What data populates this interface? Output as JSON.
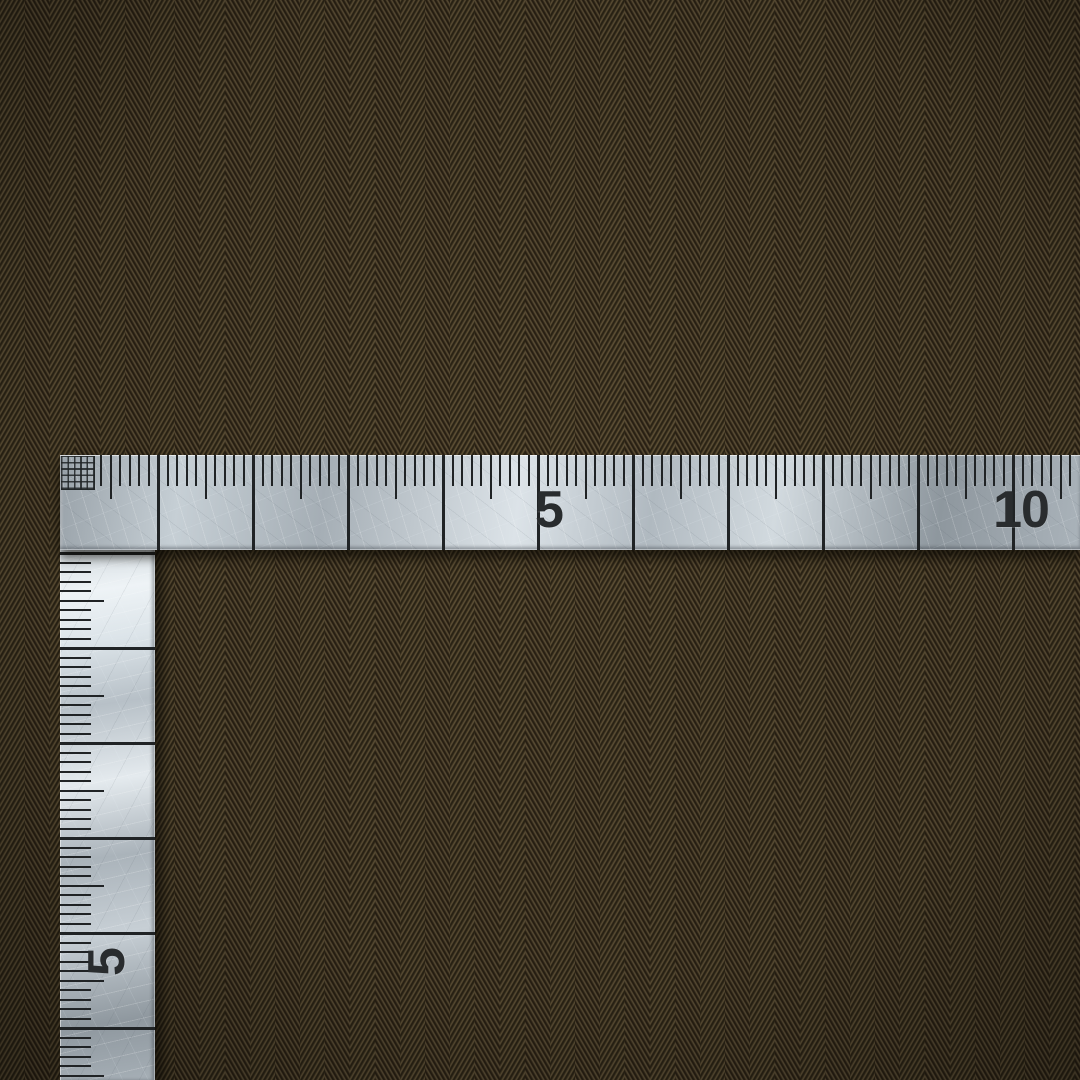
{
  "scene": {
    "kind": "photograph",
    "subject": "stainless-steel L-square ruler lying on brown herringbone twill fabric"
  },
  "ruler": {
    "shape": "L-square",
    "horizontal_arm": {
      "labels": [
        {
          "cm": 5,
          "text": "5"
        },
        {
          "cm": 10,
          "text": "10"
        }
      ]
    },
    "vertical_arm": {
      "labels": [
        {
          "cm": 5,
          "text": "5"
        }
      ]
    }
  },
  "colors": {
    "fabric_base": "#40371f",
    "fabric_thread_dark": "#2a2315",
    "fabric_thread_light": "#63553a",
    "metal_light": "#e4eaee",
    "metal_mid": "#aab3ba",
    "metal_dark": "#8e979e",
    "tick_mark": "#202325",
    "number_ink": "#292c2e"
  }
}
